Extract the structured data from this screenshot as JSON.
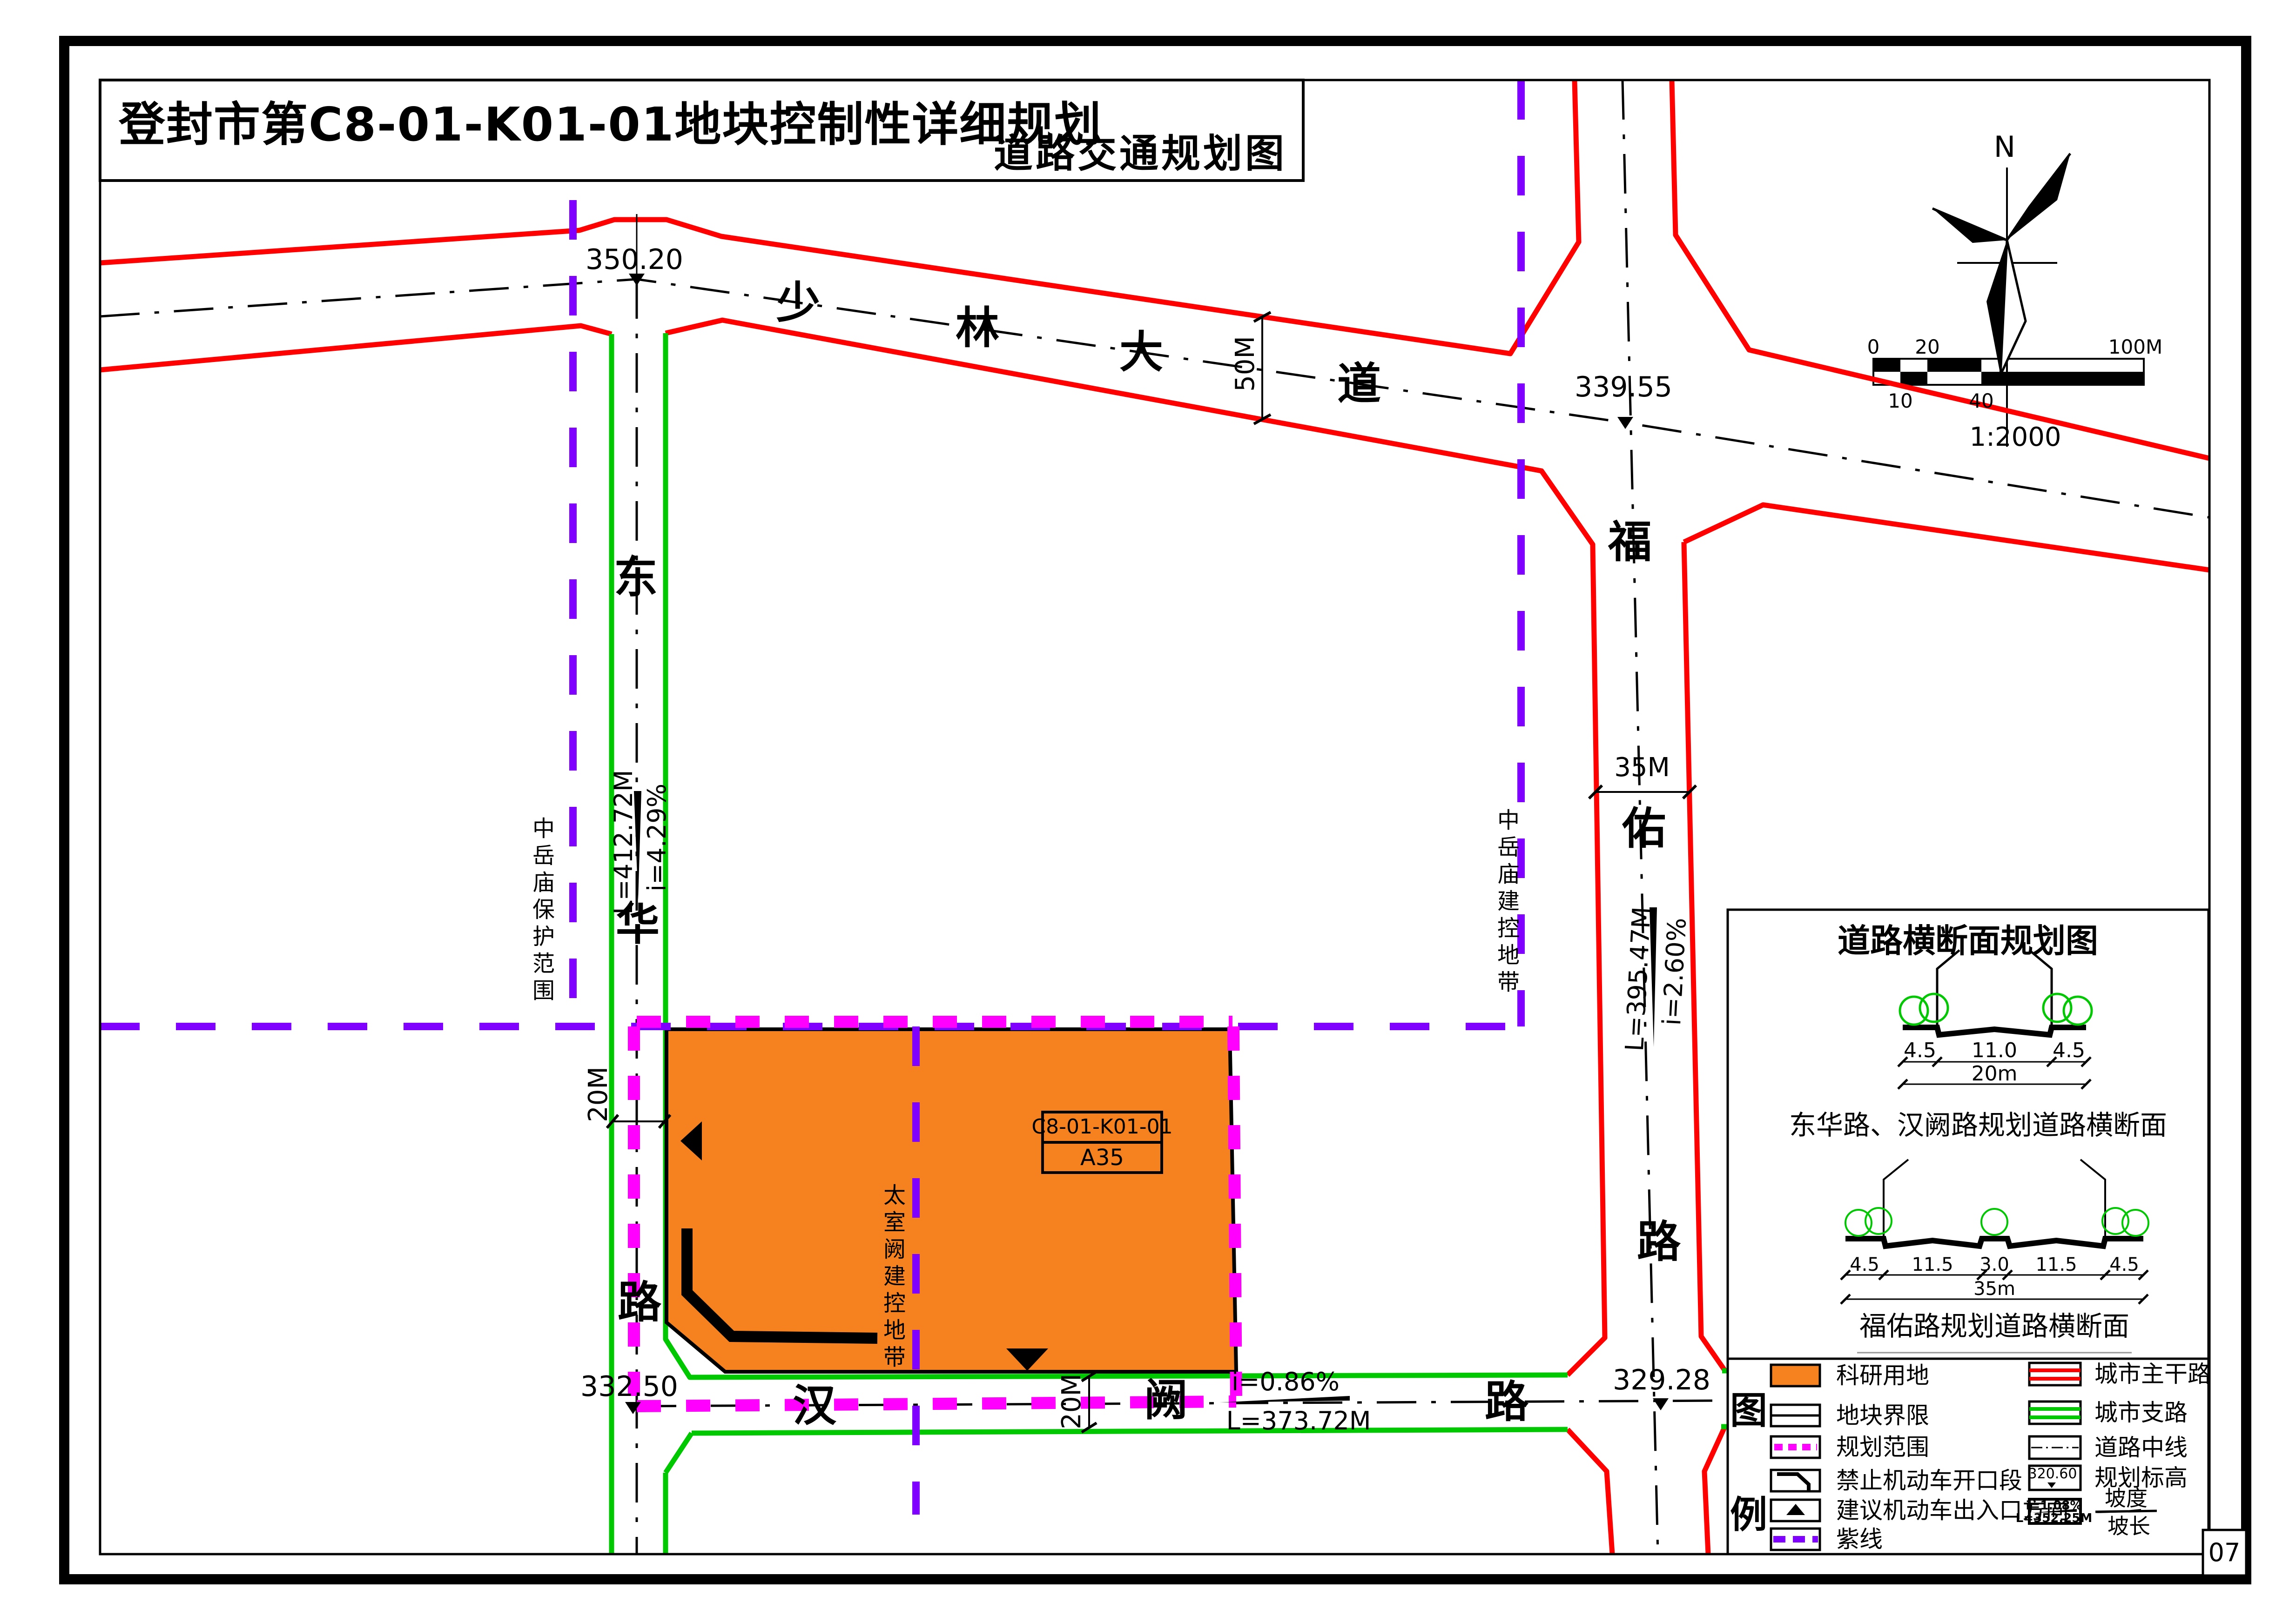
{
  "title": {
    "main": "登封市第C8-01-K01-01地块控制性详细规划",
    "sub": "道路交通规划图"
  },
  "north_label": "N",
  "scale_bar": {
    "t0": "0",
    "t20": "20",
    "t100": "100M",
    "t10": "10",
    "t40": "40",
    "ratio": "1:2000"
  },
  "roads": {
    "shaolin": [
      "少",
      "林",
      "大",
      "道"
    ],
    "donghua": [
      "东",
      "华",
      "路"
    ],
    "fuyou": [
      "福",
      "佑",
      "路"
    ],
    "hanque": [
      "汉",
      "阙",
      "路"
    ]
  },
  "elevations": {
    "sl_dh": "350.20",
    "sl_fy": "339.55",
    "hq_dh": "332.50",
    "hq_fy": "329.28"
  },
  "slopes": {
    "dh_i": "i=4.29%",
    "dh_l": "L=412.72M",
    "fy_i": "i=2.60%",
    "fy_l": "L=395.47M",
    "hq_i": "i=0.86%",
    "hq_l": "L=373.72M"
  },
  "widths": {
    "shaolin": "50M",
    "fuyou": "35M",
    "donghua": "20M",
    "hanque": "20M"
  },
  "zones": {
    "protect": "中岳庙保护范围",
    "jiankong": "中岳庙建控地带",
    "taishi": "太室阙建控地带"
  },
  "plot": {
    "code": "C8-01-K01-01",
    "no": "A35"
  },
  "cross_section": {
    "title": "道路横断面规划图",
    "s1": {
      "d1": "4.5",
      "d2": "11.0",
      "d3": "4.5",
      "total": "20m",
      "caption": "东华路、汉阙路规划道路横断面"
    },
    "s2": {
      "d1": "4.5",
      "d2": "11.5",
      "d3": "3.0",
      "d4": "11.5",
      "d5": "4.5",
      "total": "35m",
      "caption": "福佑路规划道路横断面"
    }
  },
  "legend": {
    "tu": "图",
    "li": "例",
    "left": [
      "科研用地",
      "地块界限",
      "规划范围",
      "禁止机动车开口段",
      "建议机动车出入口方向",
      "紫线"
    ],
    "right": [
      "城市主干路",
      "城市支路",
      "道路中线",
      "规划标高"
    ],
    "elev_sample": "320.60",
    "slope_i": "i=1.08%",
    "slope_l": "L=352.25M",
    "podu": "坡度",
    "pochang": "坡长"
  },
  "page_no": "07",
  "colors": {
    "orange": "#F6821F",
    "red": "#FF0000",
    "green": "#00C800",
    "purple": "#7F00FF",
    "magenta": "#FF00FF"
  }
}
